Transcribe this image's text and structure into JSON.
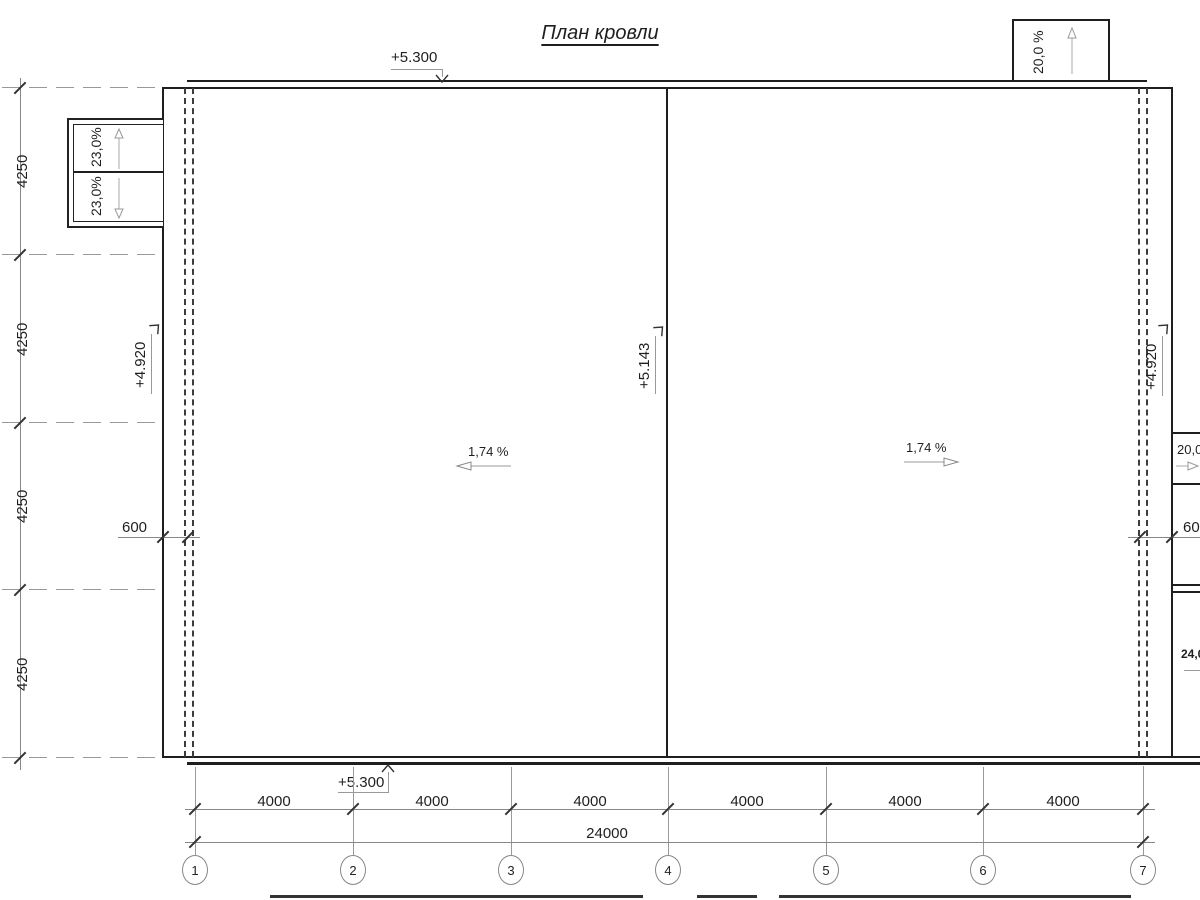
{
  "title": "План кровли",
  "marks": {
    "top": "+5.300",
    "bottom": "+5.300",
    "left": "+4.920",
    "ridge": "+5.143",
    "right": "+4.920"
  },
  "slopes": {
    "left": "1,74 %",
    "right": "1,74 %",
    "top_canopy": "20,0 %",
    "left_canopy_upper": "23,0%",
    "left_canopy_lower": "23,0%",
    "right_canopy": "20,0 %",
    "right_lower": "24,0 %"
  },
  "dims": {
    "left": [
      "4250",
      "4250",
      "4250",
      "4250"
    ],
    "bottom": [
      "4000",
      "4000",
      "4000",
      "4000",
      "4000",
      "4000"
    ],
    "total": "24000",
    "offset_left": "600",
    "offset_right": "600"
  },
  "grid": [
    "1",
    "2",
    "3",
    "4",
    "5",
    "6",
    "7"
  ]
}
